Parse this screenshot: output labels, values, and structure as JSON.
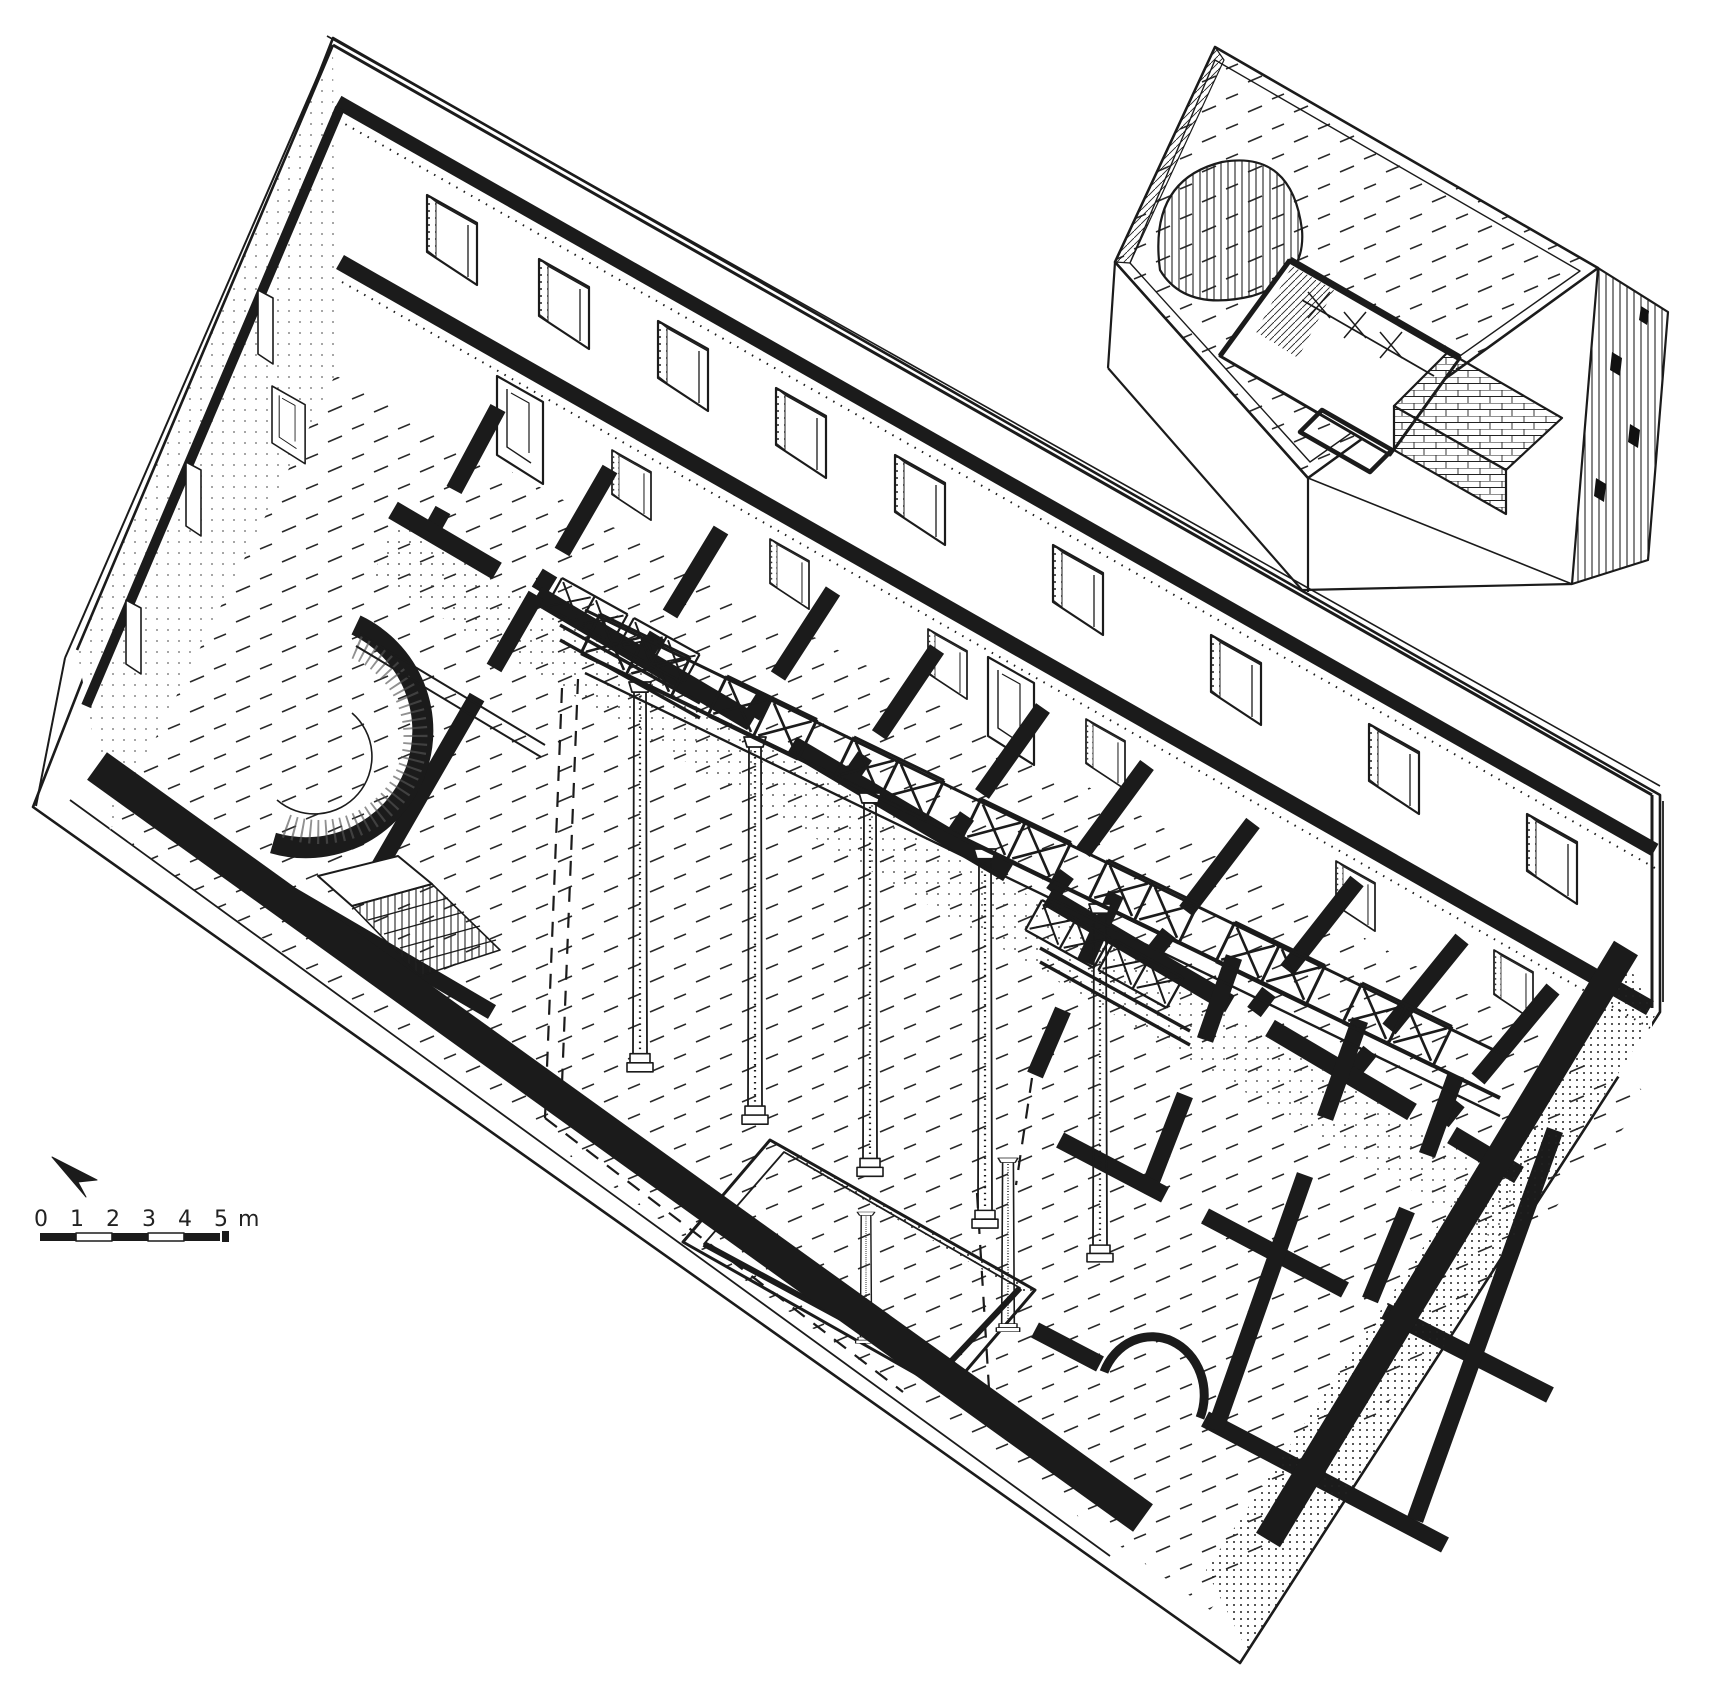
{
  "figure": {
    "kind": "axonometric cutaway line drawing",
    "subject": "masonry building with apsidal room, colonnaded atrium gallery, ranges of rooms and a separate roof-view inset",
    "ink_color": "#1b1b1b",
    "paper_color": "#ffffff"
  },
  "scale_bar": {
    "tick_labels": [
      "0",
      "1",
      "2",
      "3",
      "4",
      "5"
    ],
    "unit_label": "m",
    "segment_count": 5,
    "style": "alternating solid and open segments"
  },
  "north_arrow": {
    "glyph": "dart",
    "points": "upper-left"
  },
  "main_drawing": {
    "elements": [
      "perimeter plinth",
      "rear long wall with two window rows",
      "west end wall with slit windows",
      "sectioned low front wall",
      "apsidal room with horseshoe apse",
      "staircase with hatched steps",
      "range of rear rooms with doorways",
      "atrium with slender columns",
      "x-lattice gallery balustrade",
      "floor-level lattice parapets",
      "impluvium basin",
      "eastern room block with arched doorway",
      "dashed section-plane lines"
    ]
  },
  "inset_drawing": {
    "elements": [
      "flat roof with incised texture",
      "barrel vault over the apse",
      "atrium roof opening with lattice balustrade",
      "tiled lean-to roof",
      "hatched end wall with window slits",
      "plinth"
    ]
  }
}
